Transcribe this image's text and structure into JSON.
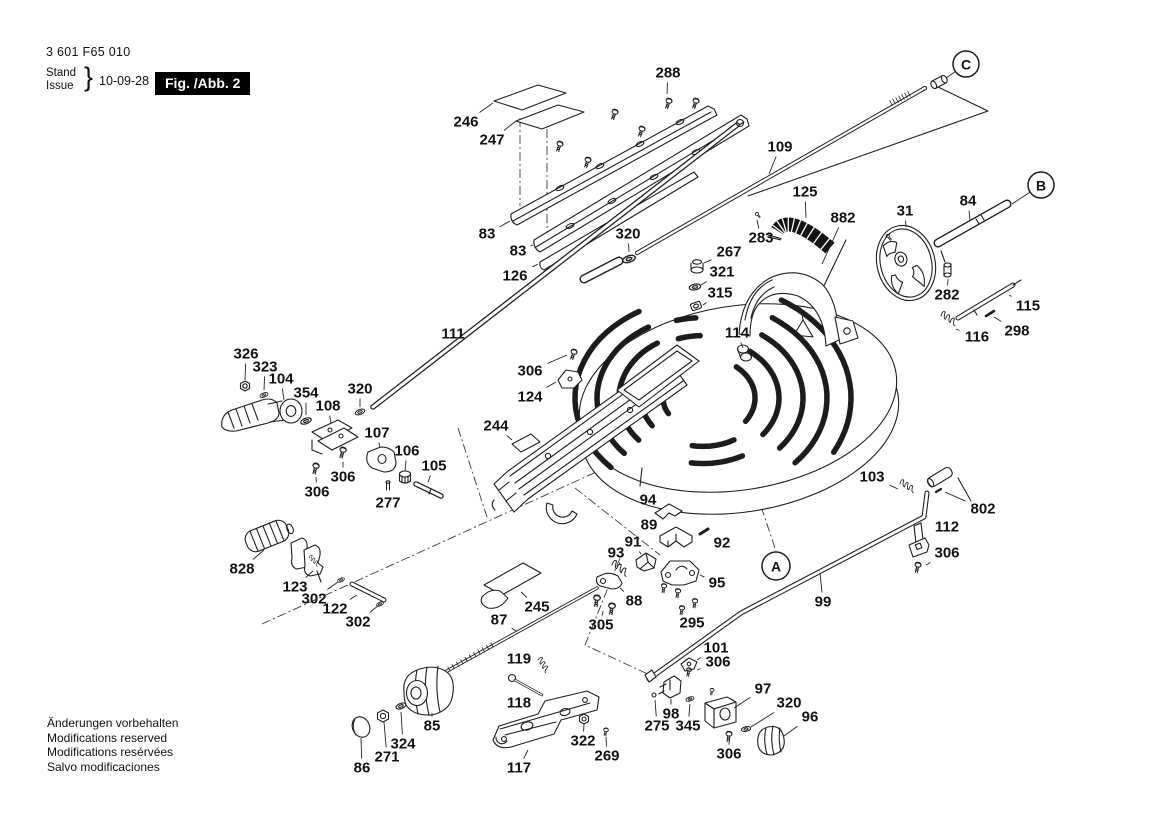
{
  "header": {
    "part_number": "3 601 F65 010",
    "stand": "Stand",
    "issue": "Issue",
    "brace": "}",
    "date": "10-09-28",
    "figure": "Fig. /Abb. 2"
  },
  "footer": {
    "lines": [
      "Änderungen vorbehalten",
      "Modifications reserved",
      "Modifications resérvées",
      "Salvo modificaciones"
    ]
  },
  "diagram": {
    "callouts": [
      {
        "t": "288",
        "x": 668,
        "y": 73,
        "lx": 667,
        "ly": 94
      },
      {
        "t": "246",
        "x": 466,
        "y": 122,
        "lx": 493,
        "ly": 103
      },
      {
        "t": "247",
        "x": 492,
        "y": 140,
        "lx": 516,
        "ly": 121
      },
      {
        "t": "83",
        "x": 487,
        "y": 234,
        "lx": 510,
        "ly": 221
      },
      {
        "t": "83",
        "x": 518,
        "y": 251,
        "lx": 533,
        "ly": 245
      },
      {
        "t": "126",
        "x": 515,
        "y": 276,
        "lx": 538,
        "ly": 264
      },
      {
        "t": "320",
        "x": 628,
        "y": 234,
        "lx": 629,
        "ly": 252
      },
      {
        "t": "267",
        "x": 729,
        "y": 252,
        "lx": 704,
        "ly": 263
      },
      {
        "t": "321",
        "x": 722,
        "y": 272,
        "lx": 701,
        "ly": 285
      },
      {
        "t": "315",
        "x": 720,
        "y": 293,
        "lx": 703,
        "ly": 305
      },
      {
        "t": "109",
        "x": 780,
        "y": 147,
        "lx": 769,
        "ly": 174
      },
      {
        "t": "125",
        "x": 805,
        "y": 192,
        "lx": 806,
        "ly": 218
      },
      {
        "t": "882",
        "x": 843,
        "y": 218,
        "lx": 822,
        "ly": 264
      },
      {
        "t": "283",
        "x": 761,
        "y": 238,
        "lx": 757,
        "ly": 220
      },
      {
        "t": "31",
        "x": 905,
        "y": 211,
        "lx": 906,
        "ly": 227
      },
      {
        "t": "84",
        "x": 968,
        "y": 201,
        "lx": 970,
        "ly": 220
      },
      {
        "t": "282",
        "x": 947,
        "y": 295,
        "lx": 948,
        "ly": 279
      },
      {
        "t": "115",
        "x": 1028,
        "y": 306,
        "lx": 1009,
        "ly": 295
      },
      {
        "t": "298",
        "x": 1017,
        "y": 331,
        "lx": 994,
        "ly": 317
      },
      {
        "t": "116",
        "x": 977,
        "y": 337,
        "lx": 956,
        "ly": 329
      },
      {
        "t": "326",
        "x": 246,
        "y": 354,
        "lx": 245,
        "ly": 380
      },
      {
        "t": "323",
        "x": 265,
        "y": 367,
        "lx": 264,
        "ly": 390
      },
      {
        "t": "104",
        "x": 281,
        "y": 379,
        "lx": 284,
        "ly": 400
      },
      {
        "t": "354",
        "x": 306,
        "y": 393,
        "lx": 306,
        "ly": 415
      },
      {
        "t": "108",
        "x": 328,
        "y": 406,
        "lx": 331,
        "ly": 423
      },
      {
        "t": "320",
        "x": 360,
        "y": 389,
        "lx": 360,
        "ly": 407
      },
      {
        "t": "111",
        "x": 453,
        "y": 334,
        "lx": 467,
        "ly": 344
      },
      {
        "t": "107",
        "x": 377,
        "y": 433,
        "lx": 380,
        "ly": 448
      },
      {
        "t": "106",
        "x": 407,
        "y": 451,
        "lx": 405,
        "ly": 471
      },
      {
        "t": "105",
        "x": 434,
        "y": 466,
        "lx": 428,
        "ly": 482
      },
      {
        "t": "306",
        "x": 343,
        "y": 477,
        "lx": 343,
        "ly": 462
      },
      {
        "t": "306",
        "x": 317,
        "y": 492,
        "lx": 316,
        "ly": 477
      },
      {
        "t": "277",
        "x": 388,
        "y": 503,
        "lx": 388,
        "ly": 492
      },
      {
        "t": "306",
        "x": 530,
        "y": 371,
        "lx": 567,
        "ly": 355
      },
      {
        "t": "124",
        "x": 530,
        "y": 397,
        "lx": 556,
        "ly": 382
      },
      {
        "t": "244",
        "x": 496,
        "y": 426,
        "lx": 512,
        "ly": 440
      },
      {
        "t": "114",
        "x": 737,
        "y": 333,
        "lx": 743,
        "ly": 348
      },
      {
        "t": "94",
        "x": 648,
        "y": 500,
        "lx": 660,
        "ly": 508
      },
      {
        "t": "89",
        "x": 649,
        "y": 525,
        "lx": 663,
        "ly": 534
      },
      {
        "t": "92",
        "x": 722,
        "y": 543,
        "lx": 709,
        "ly": 534
      },
      {
        "t": "91",
        "x": 633,
        "y": 542,
        "lx": 641,
        "ly": 554
      },
      {
        "t": "93",
        "x": 616,
        "y": 553,
        "lx": 620,
        "ly": 565
      },
      {
        "t": "95",
        "x": 717,
        "y": 583,
        "lx": 700,
        "ly": 575
      },
      {
        "t": "88",
        "x": 634,
        "y": 601,
        "lx": 620,
        "ly": 588
      },
      {
        "t": "305",
        "x": 601,
        "y": 625,
        "lx": 603,
        "ly": 611
      },
      {
        "t": "295",
        "x": 692,
        "y": 623,
        "lx": 686,
        "ly": 612
      },
      {
        "t": "99",
        "x": 823,
        "y": 602,
        "lx": 820,
        "ly": 573
      },
      {
        "t": "103",
        "x": 872,
        "y": 477,
        "lx": 898,
        "ly": 489
      },
      {
        "t": "802",
        "x": 983,
        "y": 509,
        "lx": 945,
        "ly": 492
      },
      {
        "t": "112",
        "x": 947,
        "y": 527,
        "lx": 929,
        "ly": 537
      },
      {
        "t": "306",
        "x": 947,
        "y": 553,
        "lx": 926,
        "ly": 565
      },
      {
        "t": "101",
        "x": 716,
        "y": 648,
        "lx": 697,
        "ly": 660
      },
      {
        "t": "306",
        "x": 718,
        "y": 662,
        "lx": 697,
        "ly": 670
      },
      {
        "t": "98",
        "x": 671,
        "y": 714,
        "lx": 671,
        "ly": 699
      },
      {
        "t": "275",
        "x": 657,
        "y": 726,
        "lx": 655,
        "ly": 700
      },
      {
        "t": "345",
        "x": 688,
        "y": 726,
        "lx": 690,
        "ly": 704
      },
      {
        "t": "97",
        "x": 763,
        "y": 689,
        "lx": 734,
        "ly": 708
      },
      {
        "t": "320",
        "x": 789,
        "y": 703,
        "lx": 751,
        "ly": 727
      },
      {
        "t": "96",
        "x": 810,
        "y": 717,
        "lx": 784,
        "ly": 736
      },
      {
        "t": "306",
        "x": 729,
        "y": 754,
        "lx": 729,
        "ly": 742
      },
      {
        "t": "828",
        "x": 242,
        "y": 569,
        "lx": 264,
        "ly": 550
      },
      {
        "t": "123",
        "x": 295,
        "y": 587,
        "lx": 313,
        "ly": 571
      },
      {
        "t": "302",
        "x": 314,
        "y": 599,
        "lx": 338,
        "ly": 582
      },
      {
        "t": "122",
        "x": 335,
        "y": 609,
        "lx": 357,
        "ly": 595
      },
      {
        "t": "302",
        "x": 358,
        "y": 622,
        "lx": 379,
        "ly": 605
      },
      {
        "t": "87",
        "x": 499,
        "y": 620,
        "lx": 516,
        "ly": 631
      },
      {
        "t": "245",
        "x": 537,
        "y": 607,
        "lx": 521,
        "ly": 592
      },
      {
        "t": "119",
        "x": 519,
        "y": 659,
        "lx": 537,
        "ly": 668
      },
      {
        "t": "118",
        "x": 519,
        "y": 703,
        "lx": 524,
        "ly": 694
      },
      {
        "t": "85",
        "x": 432,
        "y": 726,
        "lx": 432,
        "ly": 713
      },
      {
        "t": "324",
        "x": 403,
        "y": 744,
        "lx": 401,
        "ly": 712
      },
      {
        "t": "271",
        "x": 387,
        "y": 757,
        "lx": 384,
        "ly": 722
      },
      {
        "t": "86",
        "x": 362,
        "y": 768,
        "lx": 361,
        "ly": 738
      },
      {
        "t": "117",
        "x": 519,
        "y": 768,
        "lx": 528,
        "ly": 750
      },
      {
        "t": "322",
        "x": 583,
        "y": 741,
        "lx": 584,
        "ly": 724
      },
      {
        "t": "269",
        "x": 607,
        "y": 756,
        "lx": 606,
        "ly": 737
      }
    ],
    "refs": [
      {
        "t": "C",
        "x": 966,
        "y": 64,
        "r": 13,
        "lx": 946,
        "ly": 78
      },
      {
        "t": "B",
        "x": 1041,
        "y": 185,
        "r": 13,
        "lx": 1012,
        "ly": 204
      },
      {
        "t": "A",
        "x": 776,
        "y": 566,
        "r": 14
      }
    ]
  }
}
